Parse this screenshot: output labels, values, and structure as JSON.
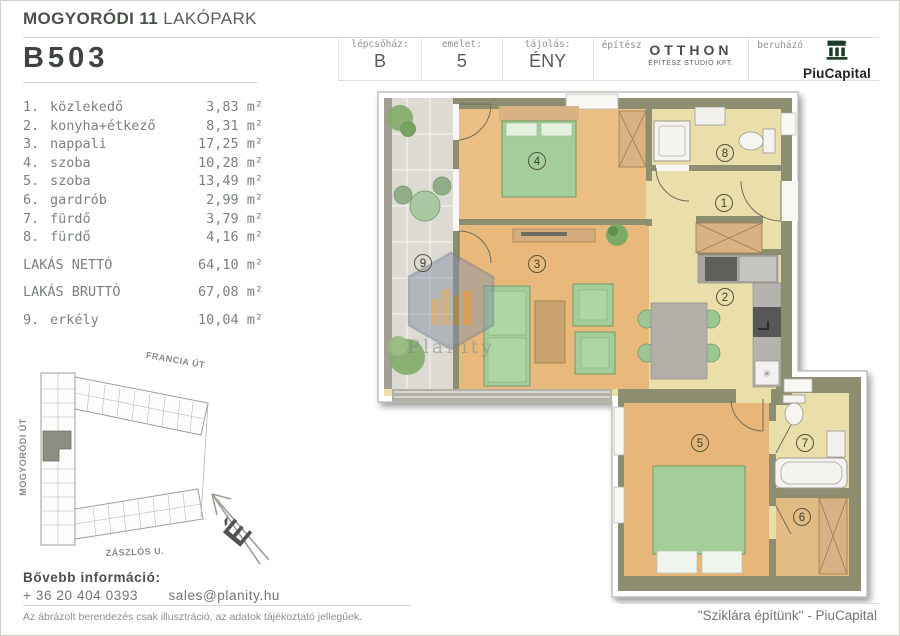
{
  "header": {
    "project_bold": "MOGYORÓDI 11",
    "project_light": "LAKÓPARK",
    "unit_id": "B503",
    "info": {
      "staircase_label": "lépcsőház:",
      "staircase_value": "B",
      "floor_label": "emelet:",
      "floor_value": "5",
      "orientation_label": "tájolás:",
      "orientation_value": "ÉNY",
      "architect_label": "építész",
      "architect_name": "OTTHON",
      "architect_sub": "ÉPÍTÉSZ STÚDIÓ KFT.",
      "developer_label": "beruházó",
      "developer_name": "PiuCapital"
    }
  },
  "room_list": {
    "rooms": [
      {
        "num": "1.",
        "name": "közlekedő",
        "area": "3,83 m²"
      },
      {
        "num": "2.",
        "name": "konyha+étkező",
        "area": "8,31 m²"
      },
      {
        "num": "3.",
        "name": "nappali",
        "area": "17,25 m²"
      },
      {
        "num": "4.",
        "name": "szoba",
        "area": "10,28 m²"
      },
      {
        "num": "5.",
        "name": "szoba",
        "area": "13,49 m²"
      },
      {
        "num": "6.",
        "name": "gardrób",
        "area": "2,99 m²"
      },
      {
        "num": "7.",
        "name": "fürdő",
        "area": "3,79 m²"
      },
      {
        "num": "8.",
        "name": "fürdő",
        "area": "4,16 m²"
      }
    ],
    "net_label": "LAKÁS NETTÓ",
    "net_area": "64,10 m²",
    "gross_label": "LAKÁS BRUTTÓ",
    "gross_area": "67,08 m²",
    "balcony_num": "9.",
    "balcony_name": "erkély",
    "balcony_area": "10,04 m²"
  },
  "floor_plan": {
    "room_numbers": [
      "1",
      "2",
      "3",
      "4",
      "5",
      "6",
      "7",
      "8",
      "9"
    ],
    "watermark": "Planity"
  },
  "site_plan": {
    "street_top": "FRANCIA ÚT",
    "street_left": "MOGYORÓDI ÚT",
    "street_bottom": "ZÁSZLÓS U.",
    "compass_letter": "É"
  },
  "footer": {
    "info_label": "Bővebb információ:",
    "phone": "+ 36 20 404 0393",
    "email": "sales@planity.hu",
    "disclaimer": "Az ábrázolt berendezés csak illusztráció, az adatok tájékoztató jellegűek.",
    "slogan": "\"Sziklára építünk\" - PiuCapital"
  },
  "colors": {
    "wall": "#8d8d70",
    "wood_floor": "#eaba7e",
    "pale_floor": "#eadeaa",
    "balcony_floor": "#dcdad2",
    "furniture_green": "#a3cd99",
    "logo_green": "#1d3a26"
  }
}
